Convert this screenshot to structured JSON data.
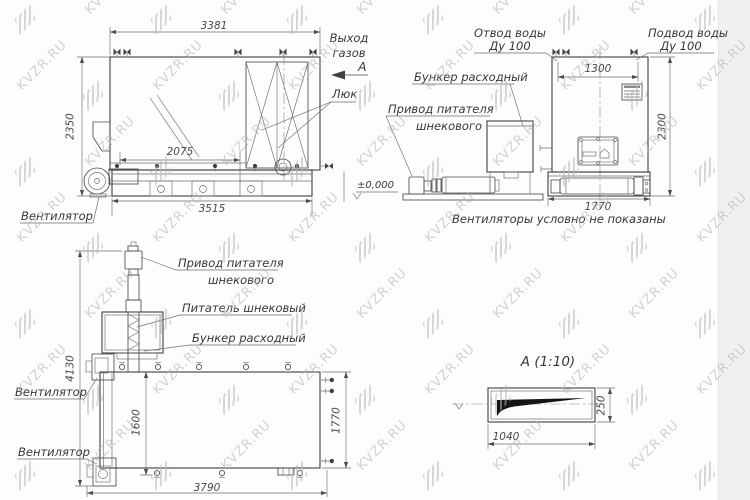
{
  "watermark": {
    "text": "KVZR.RU"
  },
  "side_view": {
    "labels": {
      "gas_outlet_line1": "Выход",
      "gas_outlet_line2": "газов",
      "section_letter": "А",
      "hatch": "Люк",
      "fan": "Вентилятор",
      "level_mark": "±0,000"
    },
    "dims": {
      "top_length": "3381",
      "height": "2350",
      "frame_length": "3515",
      "inner_length": "2075"
    }
  },
  "front_view": {
    "labels": {
      "water_outlet_line1": "Отвод воды",
      "water_outlet_line2": "Ду 100",
      "water_supply_line1": "Подвод воды",
      "water_supply_line2": "Ду 100",
      "hopper": "Бункер расходный",
      "feeder_drive_line1": "Привод питателя",
      "feeder_drive_line2": "шнекового",
      "note": "Вентиляторы условно не показаны"
    },
    "dims": {
      "top_width": "1300",
      "height": "2300",
      "width": "1770"
    }
  },
  "plan_view": {
    "labels": {
      "feeder_drive_line1": "Привод питателя",
      "feeder_drive_line2": "шнекового",
      "screw_feeder": "Питатель шнековый",
      "hopper": "Бункер расходный",
      "fan_upper": "Вентилятор",
      "fan_lower": "Вентилятор"
    },
    "dims": {
      "total_length": "4130",
      "inner_width": "1600",
      "width": "1770",
      "length": "3790"
    }
  },
  "section_view": {
    "title": "А (1:10)",
    "dims": {
      "height": "250",
      "width": "1040"
    }
  }
}
